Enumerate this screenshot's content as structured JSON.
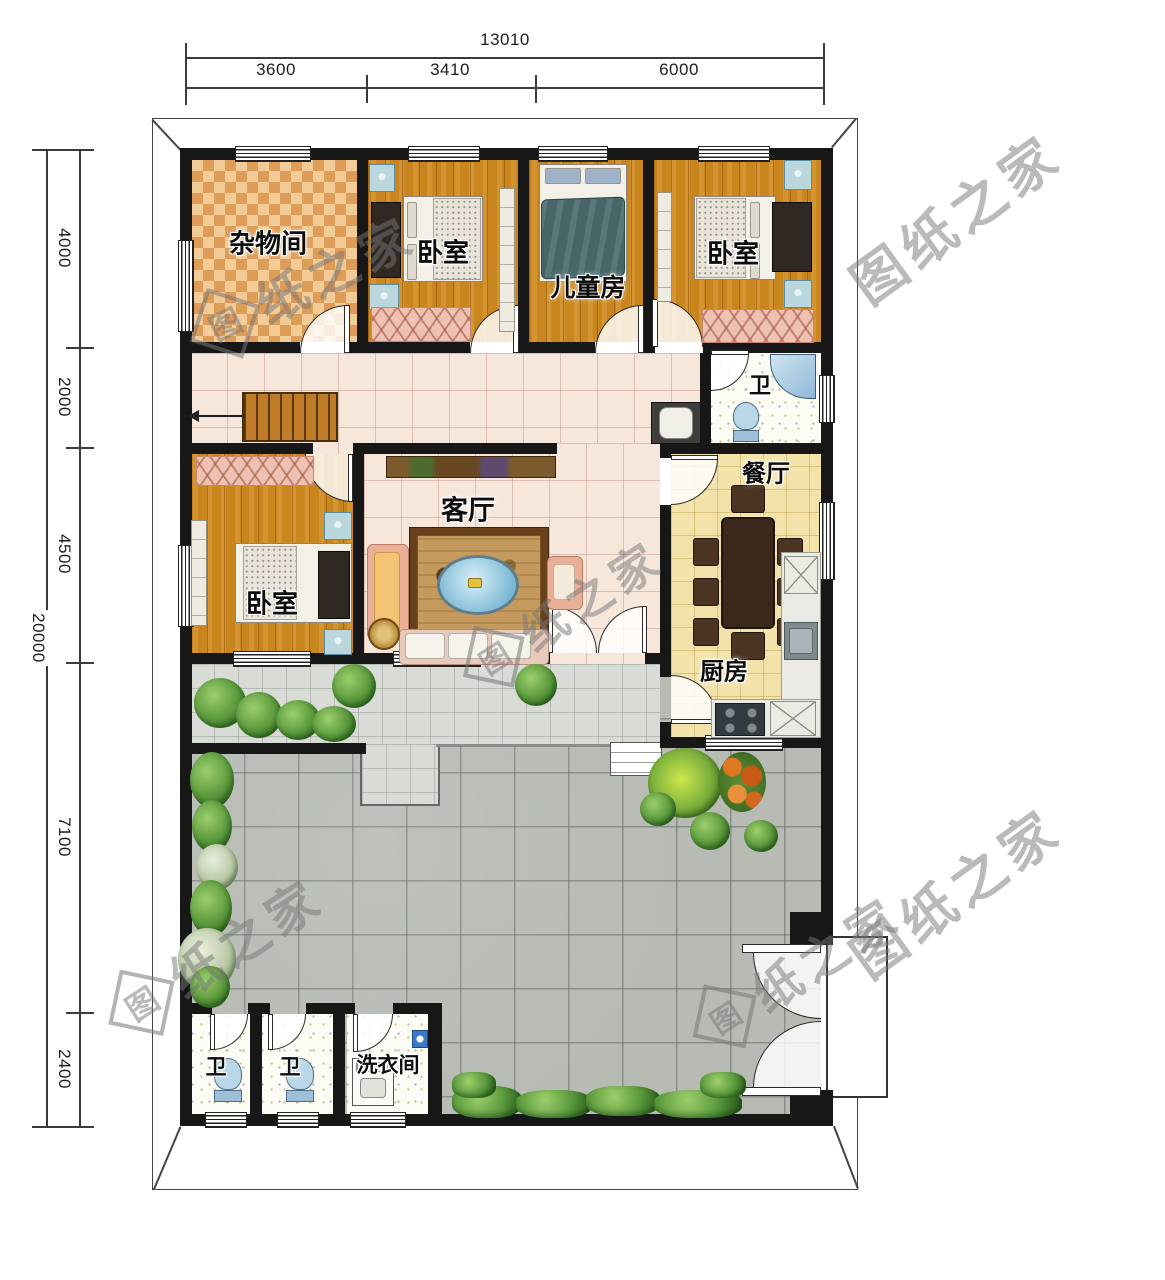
{
  "plan": {
    "watermark": {
      "brand": "图纸之家",
      "logo_char": "图",
      "tail": "纸之家"
    },
    "dimensions": {
      "top": {
        "total": "13010",
        "segments": [
          "3600",
          "3410",
          "6000"
        ]
      },
      "left": {
        "total": "20000",
        "segments": [
          "4000",
          "2000",
          "4500",
          "7100",
          "2400"
        ]
      }
    },
    "rooms": {
      "storage": "杂物间",
      "bedroom_top_left": "卧室",
      "kids_room": "儿童房",
      "bedroom_top_right": "卧室",
      "bath_middle": "卫",
      "dining": "餐厅",
      "living": "客厅",
      "bedroom_middle": "卧室",
      "kitchen": "厨房",
      "bath_bottom_1": "卫",
      "bath_bottom_2": "卫",
      "laundry": "洗衣间"
    },
    "colors": {
      "wall": "#171717",
      "wood_floor": "#c9861f",
      "storage_checker": "#dd9c58",
      "hall_tile": "#f7e7db",
      "dining_tile": "#f3e3ab",
      "terrace": "#d8dbd6",
      "courtyard": "#b7bbb4",
      "greenery": "#58973b",
      "fixture_blue": "#b9d7dc",
      "bench_pink": "#eec1b2"
    }
  }
}
